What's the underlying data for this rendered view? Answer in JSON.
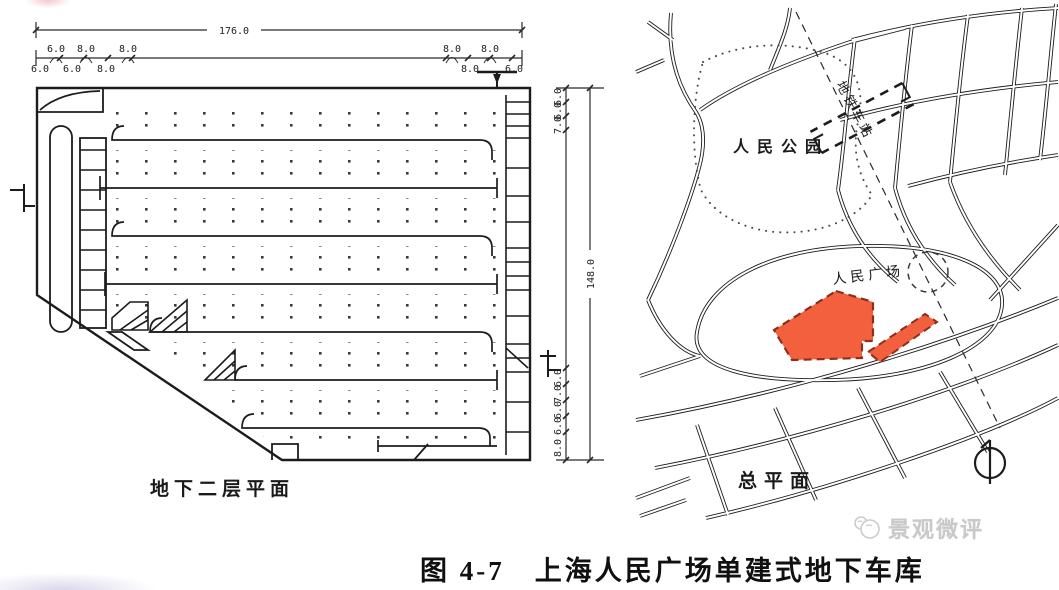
{
  "figure": {
    "caption": "图 4-7　上海人民广场单建式地下车库"
  },
  "floor_plan": {
    "title": "地下二层平面",
    "dims": {
      "total_width": "176.0",
      "total_height": "148.0",
      "width_above": [
        "6.0",
        "8.0",
        "8.0",
        "8.0",
        "8.0"
      ],
      "width_below": [
        "6.0",
        "6.0",
        "8.0",
        "8.0",
        "6.0"
      ],
      "height_top": [
        "6.0",
        "6.0",
        "7.0"
      ],
      "height_bottom": [
        "6.0",
        "7.0",
        "6.0",
        "6.0",
        "8.0"
      ]
    }
  },
  "site_plan": {
    "title": "总平面",
    "park_label": "人民公园",
    "square_label": "人民广场",
    "metro_label": "地铁车站",
    "colors": {
      "site_fill": "#f2603d",
      "site_border": "#8d2f1d",
      "ink": "#1c1c1c"
    }
  },
  "watermark": {
    "text": "景观微评"
  }
}
